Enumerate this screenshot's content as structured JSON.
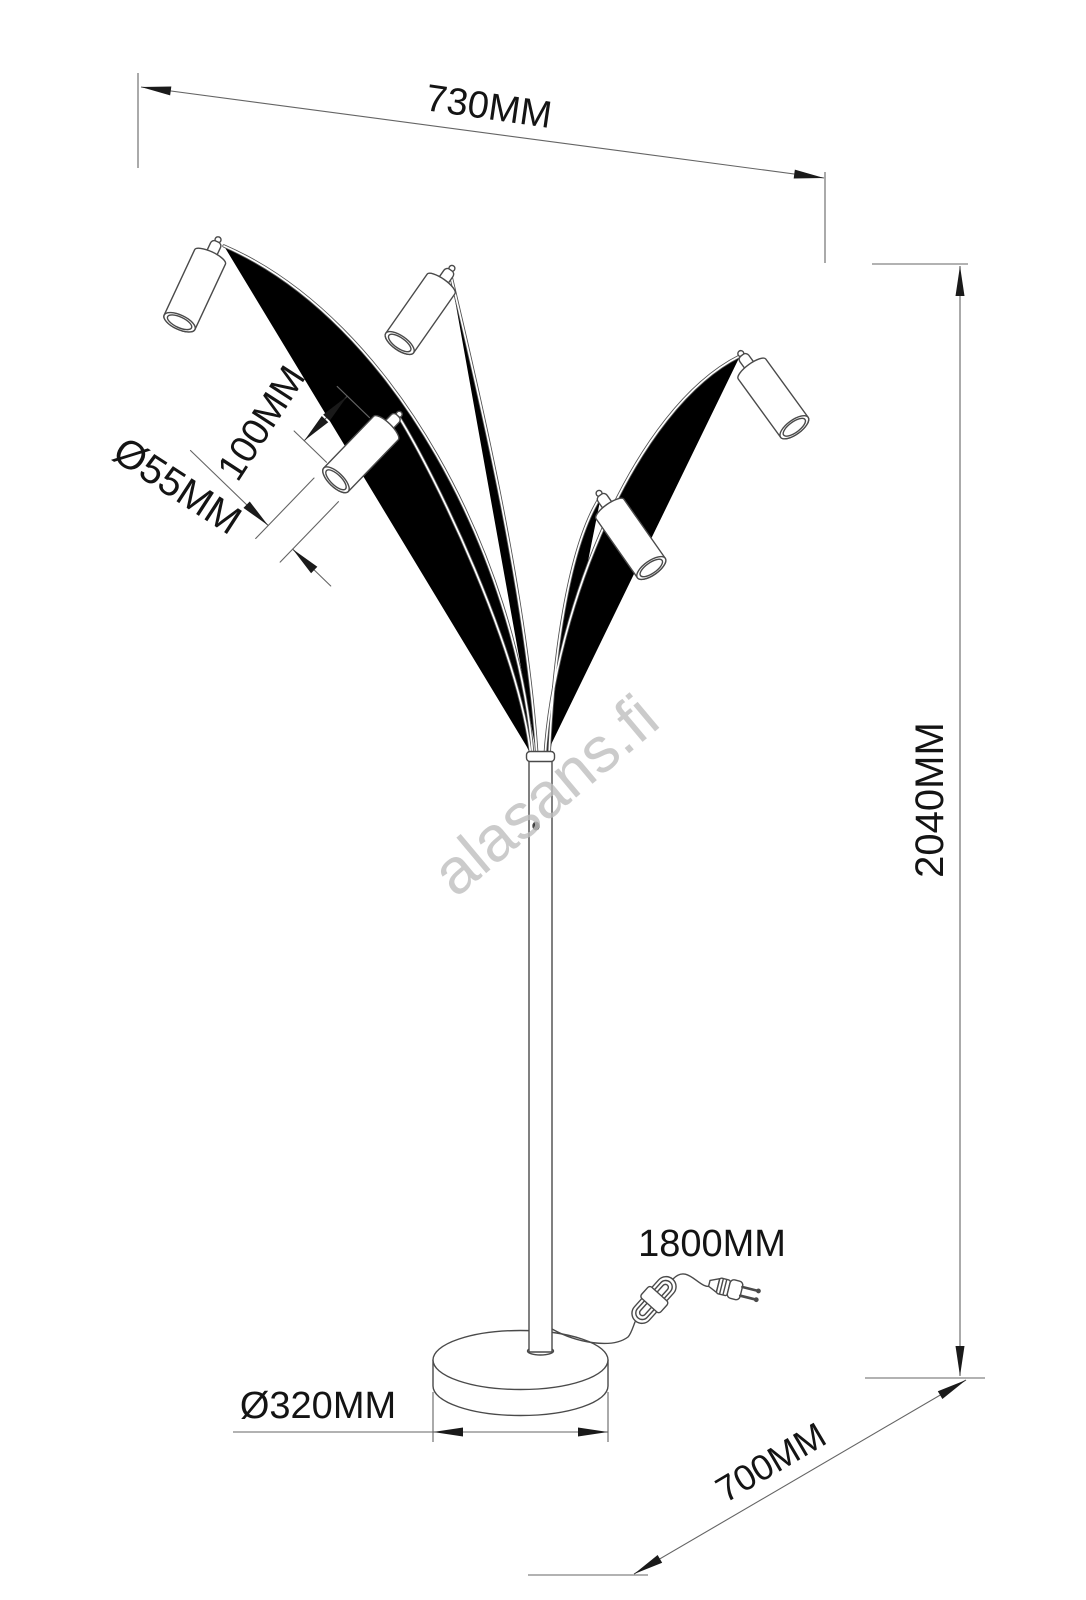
{
  "watermark": "alasans.fi",
  "dimensions": {
    "top_width": "730MM",
    "total_height": "2040MM",
    "shade_length": "100MM",
    "shade_diameter": "Ø55MM",
    "base_diameter": "Ø320MM",
    "floor_spread": "700MM",
    "cable_length": "1800MM"
  },
  "colors": {
    "line": "#4a4a4a",
    "dimension_line": "#646464",
    "label_text": "#141414",
    "watermark": "#bfbfbf",
    "background": "#ffffff"
  }
}
